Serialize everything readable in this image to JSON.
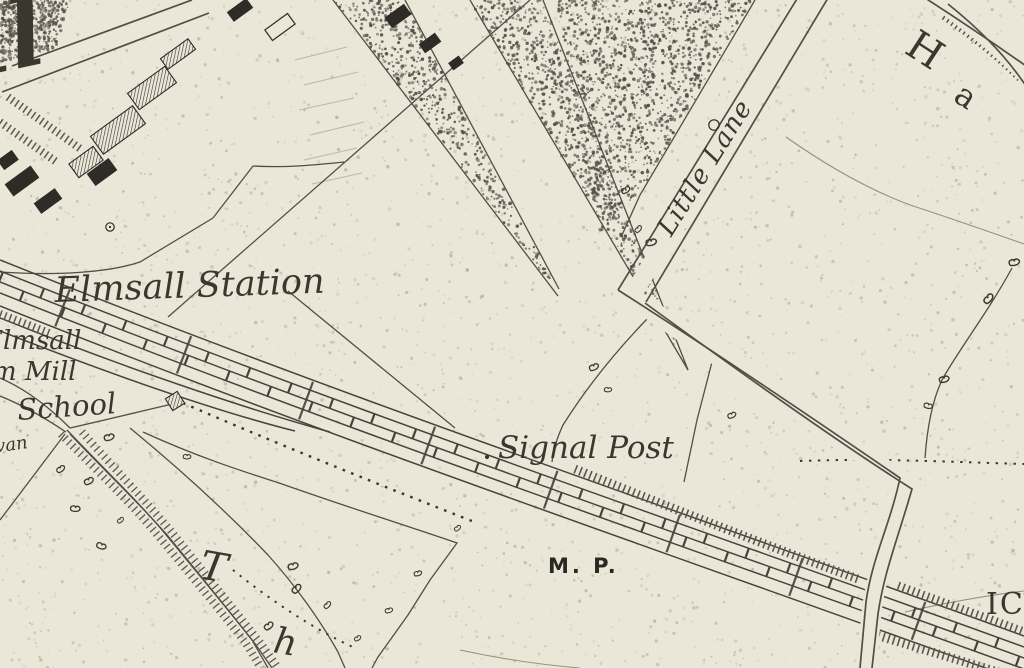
{
  "meta": {
    "kind": "historic-survey-map-extract"
  },
  "colors": {
    "paper": "#eae6d8",
    "ink": "#3a372f",
    "line": "#524e45",
    "faint": "#97927e",
    "building": "#2e2c27"
  },
  "labels": {
    "corner_flourish": "ll",
    "station": "Elmsall Station",
    "elmsall_cut": "Elmsall",
    "mill_cut": "m Mill",
    "school": "School",
    "van_cut": "van",
    "little_lane": "Little Lane",
    "signal_post": "Signal Post",
    "mile_post": "M. P.",
    "letter_T": "T",
    "letter_h": "h",
    "letter_H": "H",
    "letter_a": "a",
    "edge_number": "IC"
  }
}
